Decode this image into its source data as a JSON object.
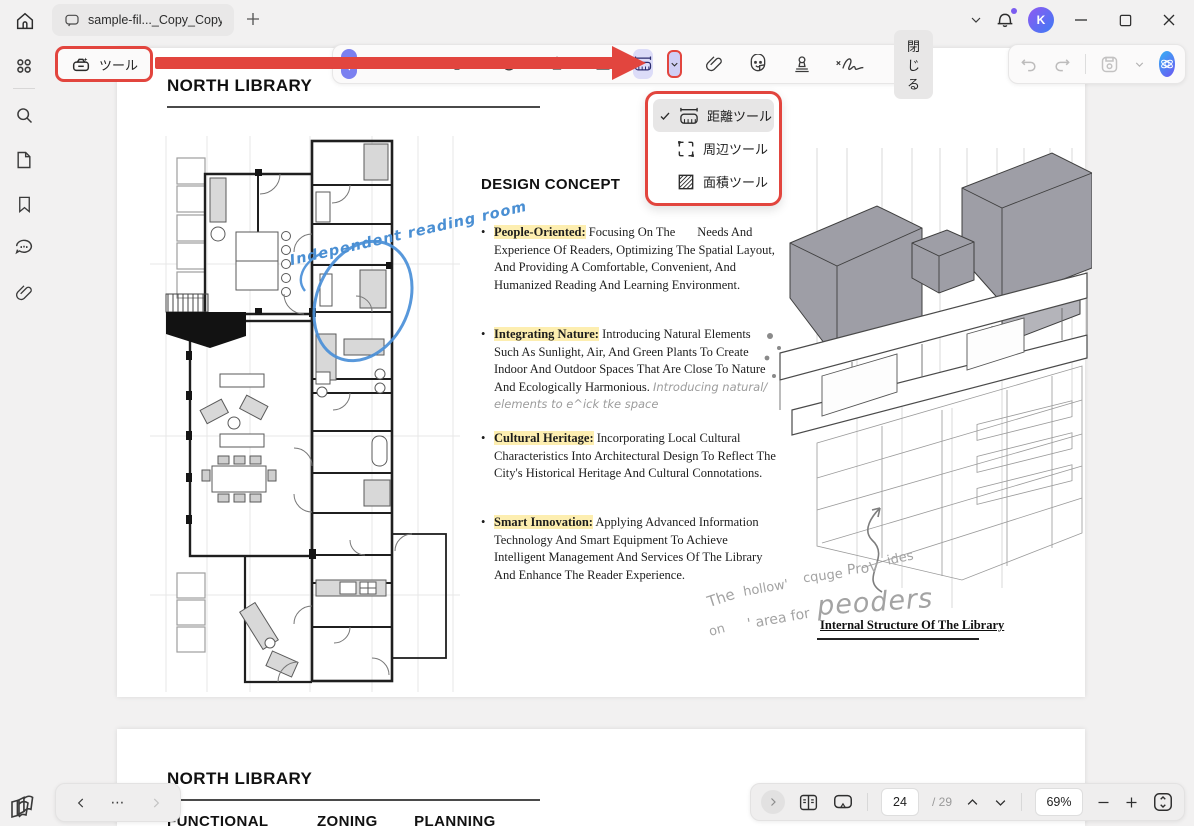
{
  "titlebar": {
    "tab_title": "sample-fil..._Copy_Copy",
    "avatar_initial": "K"
  },
  "toolbar": {
    "tools_label": "ツール",
    "close_label": "閉じる"
  },
  "measure_menu": {
    "items": [
      {
        "label": "距離ツール",
        "checked": true
      },
      {
        "label": "周辺ツール",
        "checked": false
      },
      {
        "label": "面積ツール",
        "checked": false
      }
    ]
  },
  "page1": {
    "title": "NORTH LIBRARY",
    "plan_annotation": "Independent reading room",
    "concept_heading": "DESIGN CONCEPT",
    "bullets": [
      {
        "label": "People-Oriented:",
        "text": "Focusing On The       Needs And Experience Of Readers, Optimizing The Spatial Layout, And Providing A Comfortable, Convenient, And Humanized Reading And Learning Environment."
      },
      {
        "label": "Integrating Nature:",
        "text": "Introducing Natural Elements Such As Sunlight, Air, And Green Plants To Create Indoor And Outdoor Spaces That Are Close To Nature And Ecologically Harmonious.",
        "note": "Introducing natural/ elements to e^ick tke space"
      },
      {
        "label": "Cultural Heritage:",
        "text": "Incorporating Local Cultural Characteristics Into Architectural Design To Reflect The City's Historical Heritage And Cultural Connotations."
      },
      {
        "label": "Smart Innovation:",
        "text": "Applying Advanced Information Technology And Smart Equipment To Achieve Intelligent Management And Services Of The Library And Enhance The Reader Experience."
      }
    ],
    "sketch_words": {
      "w1": "The",
      "w2": "hollow'",
      "w3": "cquge",
      "w4": "ProV",
      "w5": "ides",
      "w6": "on",
      "w7": "' area for",
      "w8": "peoders"
    },
    "sketch_caption": "Internal Structure Of The Library"
  },
  "page2": {
    "title": "NORTH LIBRARY",
    "subtitle": [
      "FUNCTIONAL",
      "ZONING",
      "PLANNING"
    ]
  },
  "bottom_bar": {
    "page_current": "24",
    "page_total": "/ 29",
    "zoom_level": "69%"
  },
  "colors": {
    "accent_red": "#e2453e",
    "accent_purple": "#7b80f0",
    "highlight_yellow": "#fdeeb0",
    "annotation_blue": "#4a8fd3"
  }
}
